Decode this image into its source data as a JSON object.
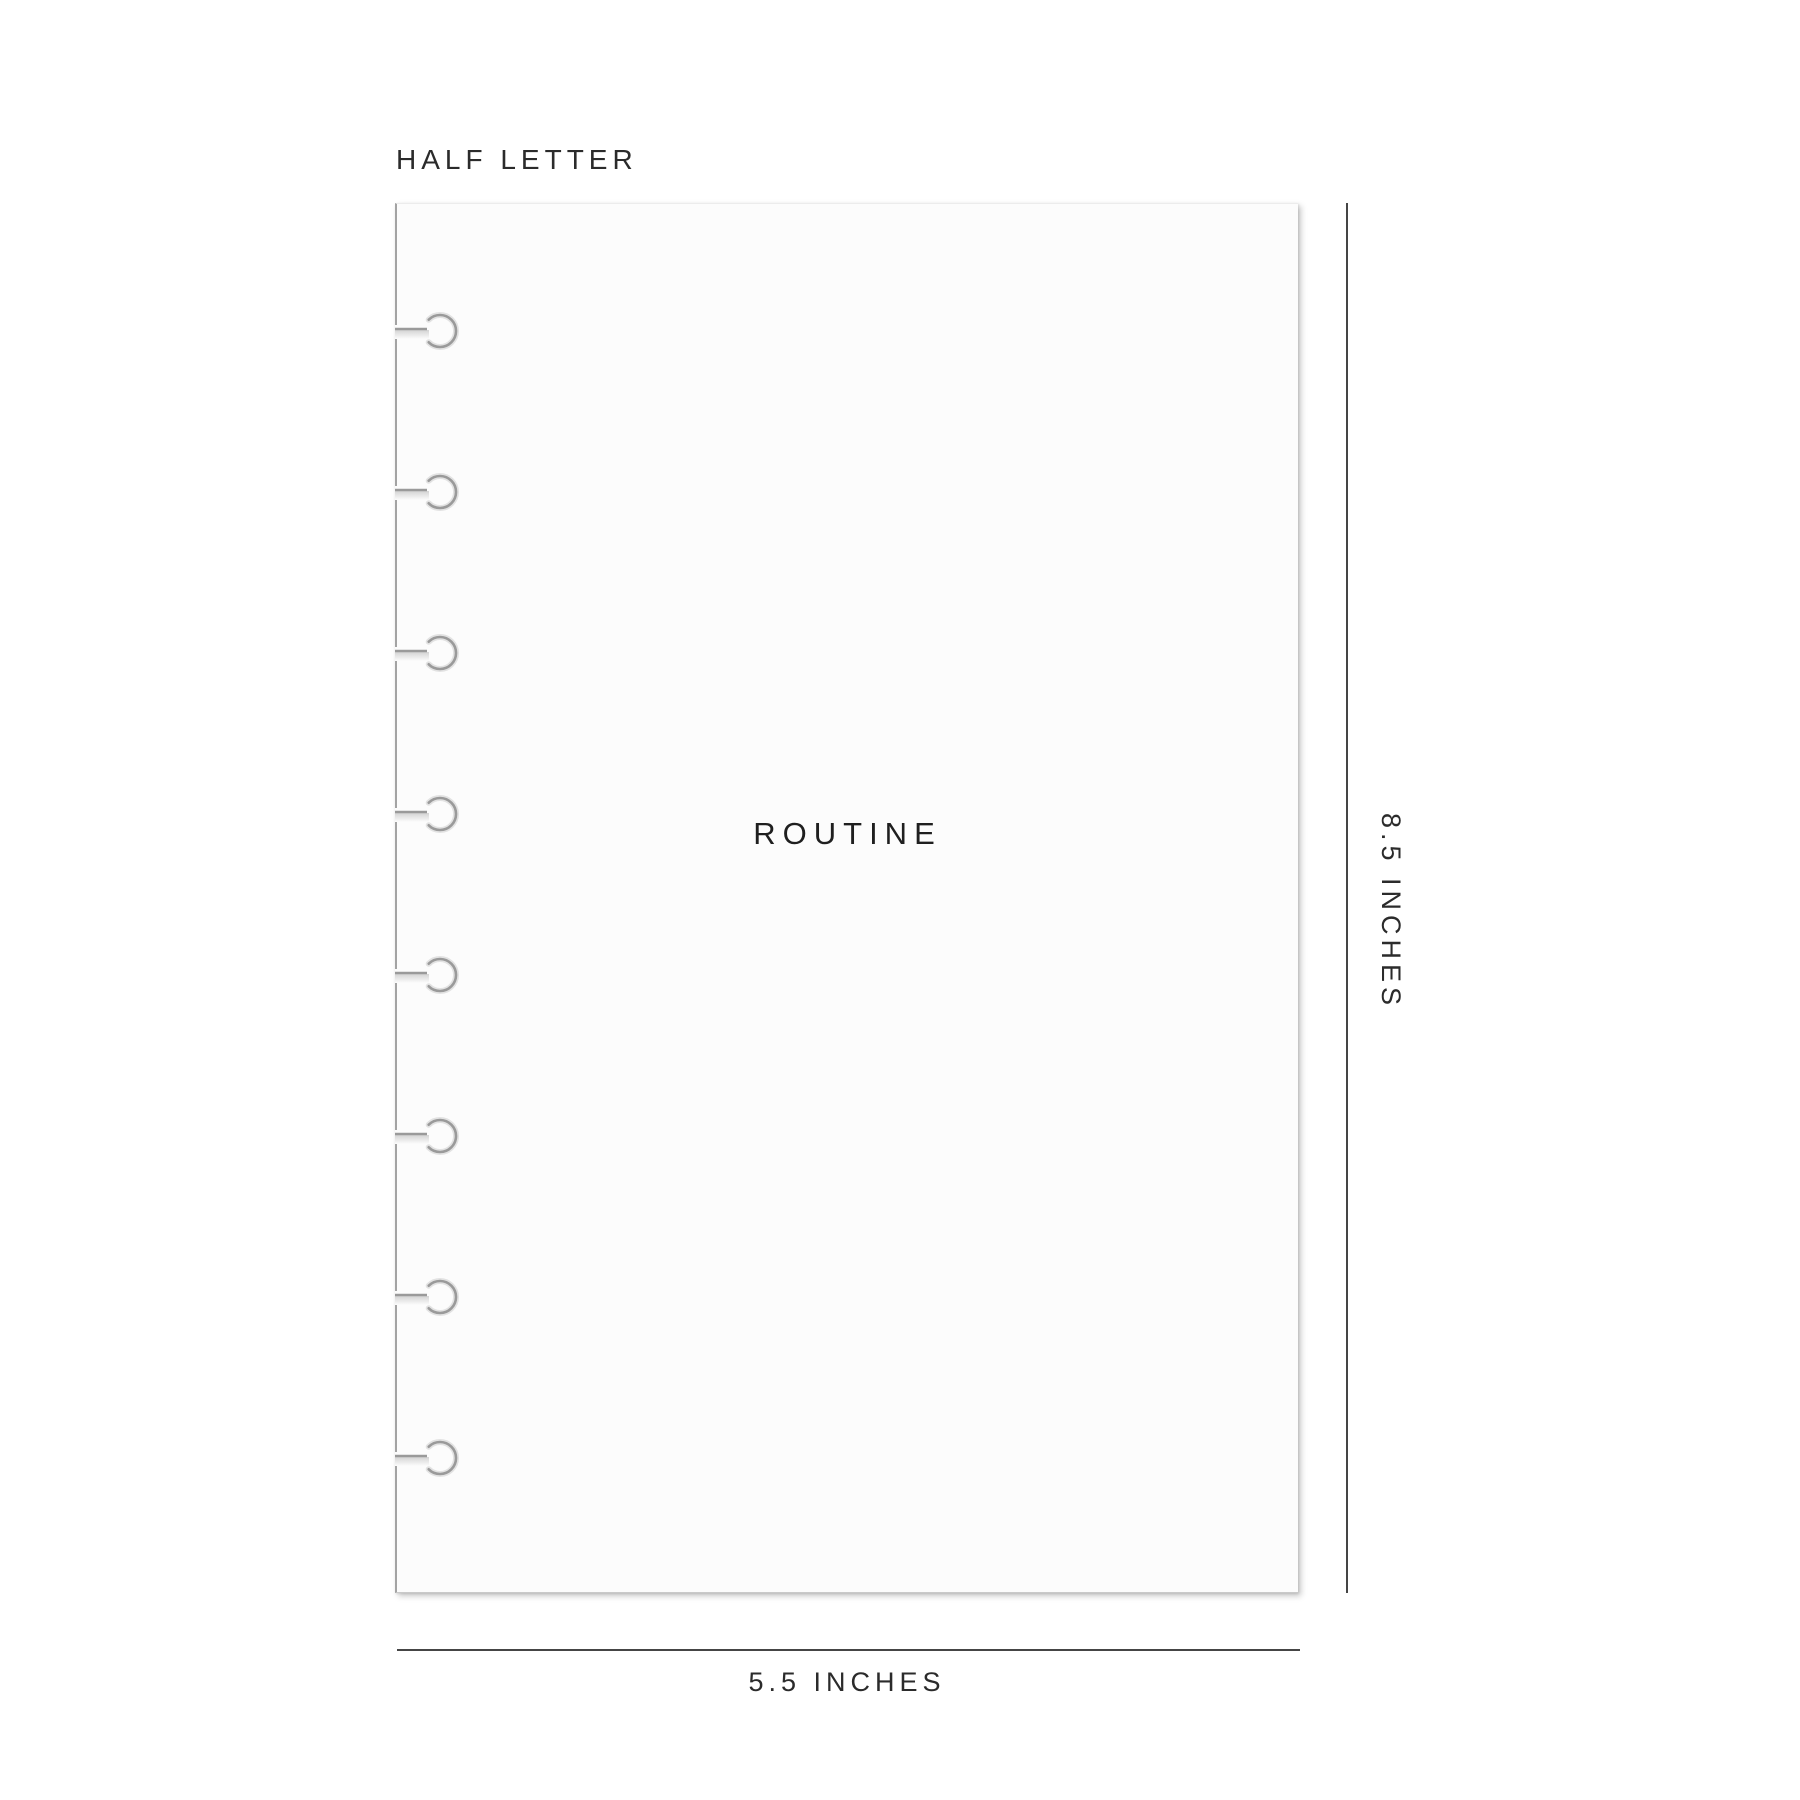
{
  "size_label": "HALF LETTER",
  "page": {
    "title": "ROUTINE",
    "hole_count": 8
  },
  "dimensions": {
    "height_label": "8.5 INCHES",
    "width_label": "5.5 INCHES"
  },
  "colors": {
    "text": "#2b2b2b",
    "dimension_line": "#454545",
    "page_edge": "#a3a3a3",
    "hole_shadow": "#9a9a9a",
    "page_bg": "#fcfcfc"
  }
}
